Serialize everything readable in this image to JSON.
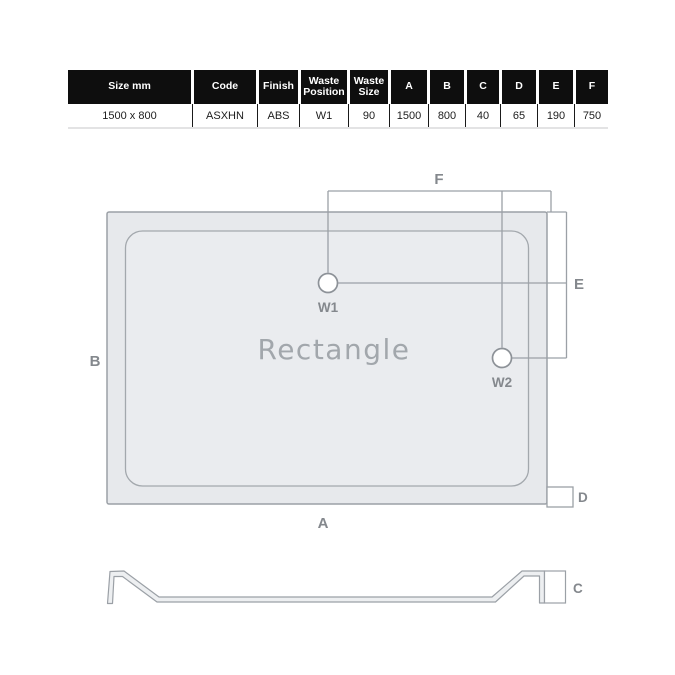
{
  "spec_table": {
    "headers": [
      "Size mm",
      "Code",
      "Finish",
      "Waste Position",
      "Waste Size",
      "A",
      "B",
      "C",
      "D",
      "E",
      "F"
    ],
    "values": [
      "1500 x 800",
      "ASXHN",
      "ABS",
      "W1",
      "90",
      "1500",
      "800",
      "40",
      "65",
      "190",
      "750"
    ]
  },
  "plan": {
    "shape_name": "Rectangle",
    "waste1_label": "W1",
    "waste2_label": "W2",
    "dim_a": "A",
    "dim_b": "B",
    "dim_d": "D",
    "dim_e": "E",
    "dim_f": "F"
  },
  "profile": {
    "dim_c": "C"
  },
  "colors": {
    "header_bg": "#0e0e0e",
    "line": "#9ba0a6",
    "label": "#84888d",
    "tray_fill": "#e7e9ec",
    "shape_label_color": "#a2a7ac"
  }
}
